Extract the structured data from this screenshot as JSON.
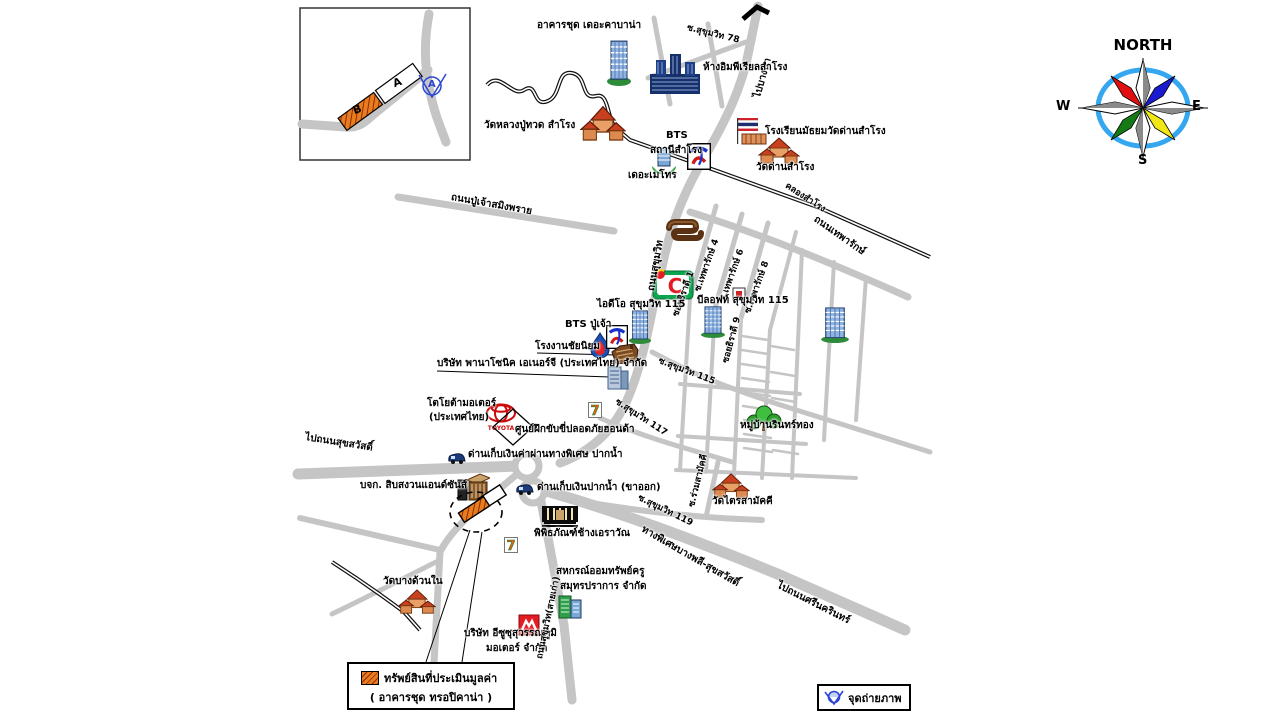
{
  "compass": {
    "north": "NORTH",
    "south": "S",
    "east": "E",
    "west": "W"
  },
  "inset": {
    "block_a": "A",
    "block_b": "B",
    "camera_label": "A"
  },
  "legend": {
    "title": "ทรัพย์สินที่ประเมินมูลค่า",
    "subtitle": "( อาคารชุด ทรอปิคาน่า )"
  },
  "photo_point": {
    "label": "จุดถ่ายภาพ"
  },
  "colors": {
    "road": "#c5c5c5",
    "canal": "#111111",
    "compass_ring": "#35a7f0",
    "hatch_orange": "#e87c1e",
    "hatch_stripe": "#8a2c05",
    "camera_blue": "#2b46d4"
  },
  "map": {
    "labels": [
      {
        "n": "condo-cabana-label",
        "t": "อาคารชุด เดอะคาบาน่า",
        "x": 537,
        "y": 20
      },
      {
        "n": "soi-sukhumvit-78-label",
        "t": "ซ.สุขุมวิท 78",
        "x": 688,
        "y": 24,
        "r": 14,
        "s": 9
      },
      {
        "n": "to-bangna-label",
        "t": "ไปบางนา",
        "x": 752,
        "y": 96,
        "r": -74
      },
      {
        "n": "imperial-samrong-label",
        "t": "ห้างอิมพีเรียลสำโรง",
        "x": 703,
        "y": 62
      },
      {
        "n": "wat-luang-pu-thuat-label",
        "t": "วัดหลวงปู่ทวด สำโรง",
        "x": 484,
        "y": 120
      },
      {
        "n": "bts-samrong-line1",
        "t": "BTS",
        "x": 666,
        "y": 130
      },
      {
        "n": "bts-samrong-line2",
        "t": "สถานีสำโรง",
        "x": 650,
        "y": 145
      },
      {
        "n": "school-wat-dan-label",
        "t": "โรงเรียนมัธยมวัดด่านสำโรง",
        "x": 765,
        "y": 126
      },
      {
        "n": "wat-dan-samrong-label",
        "t": "วัดด่านสำโรง",
        "x": 756,
        "y": 162
      },
      {
        "n": "the-metro-label",
        "t": "เดอะเมโทร",
        "x": 628,
        "y": 170
      },
      {
        "n": "khlong-samrong-label",
        "t": "คลองสำโรง",
        "x": 788,
        "y": 182,
        "r": 33,
        "s": 9
      },
      {
        "n": "pu-chao-road-label",
        "t": "ถนนปู่เจ้าสมิงพราย",
        "x": 452,
        "y": 192,
        "r": 10
      },
      {
        "n": "theparak-road-label",
        "t": "ถนนเทพารักษ์",
        "x": 818,
        "y": 214,
        "r": 35
      },
      {
        "n": "soi-theparak-4-label",
        "t": "ซ.เทพารักษ์ 4",
        "x": 694,
        "y": 290,
        "r": -70,
        "s": 9
      },
      {
        "n": "soi-theparak-6-label",
        "t": "ซ.เทพารักษ์ 6",
        "x": 719,
        "y": 300,
        "r": -70,
        "s": 9
      },
      {
        "n": "soi-theparak-8-label",
        "t": "ซ.เทพารักษ์ 8",
        "x": 744,
        "y": 312,
        "r": -70,
        "s": 9
      },
      {
        "n": "sukhumvit-road-label",
        "t": "ถนนสุขุมวิท",
        "x": 646,
        "y": 290,
        "r": -80
      },
      {
        "n": "soi-thiradi-1-label",
        "t": "ซอยธิราดี 1",
        "x": 672,
        "y": 315,
        "r": -70,
        "s": 9
      },
      {
        "n": "ideo-condo-label",
        "t": "ไอดีโอ สุขุมวิท 115",
        "x": 597,
        "y": 299
      },
      {
        "n": "beloft-condo-label",
        "t": "บีลอฟท์ สุขุมวิท 115",
        "x": 697,
        "y": 295
      },
      {
        "n": "soi-thiradi-9-label",
        "t": "ซอยธิราดี 9",
        "x": 722,
        "y": 362,
        "r": -75,
        "s": 9
      },
      {
        "n": "bts-pu-chao-label",
        "t": "BTS ปู่เจ้า",
        "x": 565,
        "y": 319
      },
      {
        "n": "chai-niyom-factory-label",
        "t": "โรงงานชัยนิยม",
        "x": 535,
        "y": 341
      },
      {
        "n": "panasonic-label",
        "t": "บริษัท พานาโซนิค เอเนอร์จี (ประเทศไทย) จำกัด",
        "x": 437,
        "y": 358
      },
      {
        "n": "soi-sukhumvit-115-label",
        "t": "ซ.สุขุมวิท 115",
        "x": 660,
        "y": 357,
        "r": 21,
        "s": 9
      },
      {
        "n": "toyota-label-1",
        "t": "โตโยต้ามอเตอร์",
        "x": 427,
        "y": 398
      },
      {
        "n": "toyota-label-2",
        "t": "(ประเทศไทย)",
        "x": 429,
        "y": 412
      },
      {
        "n": "honda-center-label",
        "t": "ศูนย์ฝึกขับขี่ปลอดภัยฮอนด้า",
        "x": 515,
        "y": 424
      },
      {
        "n": "soi-sukhumvit-117-label",
        "t": "ซ.สุขุมวิท 117",
        "x": 618,
        "y": 398,
        "r": 33,
        "s": 9
      },
      {
        "n": "toll-express-label",
        "t": "ด่านเก็บเงินค่าผ่านทางพิเศษ ปากน้ำ",
        "x": 468,
        "y": 449
      },
      {
        "n": "toll-paknam-label",
        "t": "ด่านเก็บเงินปากน้ำ (ขาออก)",
        "x": 537,
        "y": 482
      },
      {
        "n": "to-suksawat-label",
        "t": "ไปถนนสุขสวัสดิ์",
        "x": 306,
        "y": 432,
        "r": 9
      },
      {
        "n": "sibsanguan-label",
        "t": "บจก. สิบสงวนแอนด์ซันส์",
        "x": 360,
        "y": 480
      },
      {
        "n": "wat-bang-duan-label",
        "t": "วัดบางด้วนใน",
        "x": 383,
        "y": 576
      },
      {
        "n": "erawan-museum-label",
        "t": "พิพิธภัณฑ์ช้างเอราวัณ",
        "x": 534,
        "y": 528
      },
      {
        "n": "coop-label-1",
        "t": "สหกรณ์ออมทรัพย์ครู",
        "x": 556,
        "y": 566
      },
      {
        "n": "coop-label-2",
        "t": "สมุทรปราการ จำกัด",
        "x": 560,
        "y": 581
      },
      {
        "n": "isuzu-label-1",
        "t": "บริษัท อีซูซุสุวรรณภูมิ",
        "x": 464,
        "y": 628
      },
      {
        "n": "isuzu-label-2",
        "t": "มอเตอร์ จำกัด",
        "x": 486,
        "y": 643
      },
      {
        "n": "sukhumvit-old-road-label",
        "t": "ถนนสุขุมวิท(สายเก่า)",
        "x": 536,
        "y": 658,
        "r": -78,
        "s": 9
      },
      {
        "n": "expressway-label",
        "t": "ทางพิเศษบางพลี-สุขสวัสดิ์",
        "x": 645,
        "y": 524,
        "r": 30
      },
      {
        "n": "to-srinakarin-label",
        "t": "ไปถนนศรีนครินทร์",
        "x": 780,
        "y": 580,
        "r": 27
      },
      {
        "n": "soi-sukhumvit-119-label",
        "t": "ซ.สุขุมวิท 119",
        "x": 640,
        "y": 494,
        "r": 26,
        "s": 9
      },
      {
        "n": "soi-ruam-samakkhi-label",
        "t": "ซ.ร่วมสามัคคี",
        "x": 688,
        "y": 506,
        "r": -76,
        "s": 9
      },
      {
        "n": "wat-trai-samakkhi-label",
        "t": "วัดไตรสามัคคี",
        "x": 712,
        "y": 496
      },
      {
        "n": "rinthong-village-label",
        "t": "หมู่บ้านรินทร์ทอง",
        "x": 740,
        "y": 420
      }
    ],
    "icons": [
      {
        "n": "cabana-condo-icon",
        "type": "condo",
        "x": 606,
        "y": 40,
        "w": 26,
        "h": 46
      },
      {
        "n": "imperial-mall-icon",
        "type": "mall",
        "x": 648,
        "y": 52,
        "w": 54,
        "h": 48
      },
      {
        "n": "wat-luang-pu-thuat-icon",
        "type": "temple",
        "x": 580,
        "y": 104,
        "w": 46,
        "h": 40
      },
      {
        "n": "school-flag-icon",
        "type": "school",
        "x": 736,
        "y": 118,
        "w": 32,
        "h": 28
      },
      {
        "n": "wat-dan-samrong-icon",
        "type": "temple",
        "x": 758,
        "y": 136,
        "w": 42,
        "h": 30
      },
      {
        "n": "the-metro-icon",
        "type": "metro",
        "x": 650,
        "y": 146,
        "w": 28,
        "h": 28
      },
      {
        "n": "bts-samrong-logo-icon",
        "type": "bts",
        "x": 687,
        "y": 143,
        "w": 24,
        "h": 27
      },
      {
        "n": "market-icon",
        "type": "market",
        "x": 666,
        "y": 218,
        "w": 38,
        "h": 26
      },
      {
        "n": "big-c-icon",
        "type": "bigc",
        "x": 652,
        "y": 268,
        "w": 42,
        "h": 32,
        "g": "C"
      },
      {
        "n": "ideo-condo-icon",
        "type": "condo",
        "x": 628,
        "y": 310,
        "w": 24,
        "h": 34
      },
      {
        "n": "beloft-condo-icon",
        "type": "condo",
        "x": 700,
        "y": 306,
        "w": 26,
        "h": 32
      },
      {
        "n": "condo-building-icon",
        "type": "condo",
        "x": 820,
        "y": 307,
        "w": 30,
        "h": 36
      },
      {
        "n": "shrine-icon",
        "type": "shrine",
        "x": 732,
        "y": 286,
        "w": 14,
        "h": 16
      },
      {
        "n": "gas-station-icon",
        "type": "gas",
        "x": 590,
        "y": 332,
        "w": 20,
        "h": 26
      },
      {
        "n": "bts-pu-chao-logo-icon",
        "type": "bts",
        "x": 606,
        "y": 325,
        "w": 22,
        "h": 24
      },
      {
        "n": "chai-niyom-factory-icon",
        "type": "factory",
        "x": 610,
        "y": 342,
        "w": 30,
        "h": 26
      },
      {
        "n": "panasonic-building-icon",
        "type": "office",
        "x": 606,
        "y": 364,
        "w": 24,
        "h": 26
      },
      {
        "n": "toyota-logo-icon",
        "type": "toyota",
        "x": 484,
        "y": 402,
        "w": 34,
        "h": 30,
        "g": "TOYOTA"
      },
      {
        "n": "honda-center-diamond-icon",
        "type": "diamond",
        "x": 492,
        "y": 408,
        "w": 42,
        "h": 38
      },
      {
        "n": "seven-eleven-icon",
        "type": "seven",
        "x": 588,
        "y": 402,
        "w": 14,
        "h": 16,
        "g": "7"
      },
      {
        "n": "toll-truck-icon",
        "type": "truck",
        "x": 448,
        "y": 451,
        "w": 18,
        "h": 14
      },
      {
        "n": "toll-truck-icon-2",
        "type": "truck",
        "x": 516,
        "y": 482,
        "w": 18,
        "h": 14
      },
      {
        "n": "sibsanguan-building-icon",
        "type": "brown",
        "x": 456,
        "y": 472,
        "w": 34,
        "h": 30
      },
      {
        "n": "property-dashed-circle",
        "type": "dashed",
        "x": 448,
        "y": 490,
        "w": 56,
        "h": 44
      },
      {
        "n": "property-block-a",
        "type": "whiteblock",
        "x": 478,
        "y": 490,
        "w": 28,
        "h": 14,
        "r": -33
      },
      {
        "n": "property-block-b",
        "type": "hatchblock",
        "x": 458,
        "y": 503,
        "w": 32,
        "h": 13,
        "r": -33
      },
      {
        "n": "seven-eleven-icon-3",
        "type": "seven",
        "x": 504,
        "y": 537,
        "w": 14,
        "h": 16,
        "g": "7"
      },
      {
        "n": "erawan-museum-icon",
        "type": "museum",
        "x": 540,
        "y": 504,
        "w": 40,
        "h": 26
      },
      {
        "n": "wat-bang-duan-icon",
        "type": "temple",
        "x": 398,
        "y": 588,
        "w": 38,
        "h": 28
      },
      {
        "n": "coop-building-icon",
        "type": "greenbld",
        "x": 556,
        "y": 592,
        "w": 28,
        "h": 28
      },
      {
        "n": "isuzu-logo-icon",
        "type": "isuzu",
        "x": 518,
        "y": 614,
        "w": 22,
        "h": 22
      },
      {
        "n": "wat-trai-samakkhi-icon",
        "type": "temple",
        "x": 712,
        "y": 472,
        "w": 38,
        "h": 28
      },
      {
        "n": "rinthong-trees-icon",
        "type": "trees",
        "x": 744,
        "y": 404,
        "w": 40,
        "h": 30
      }
    ]
  }
}
